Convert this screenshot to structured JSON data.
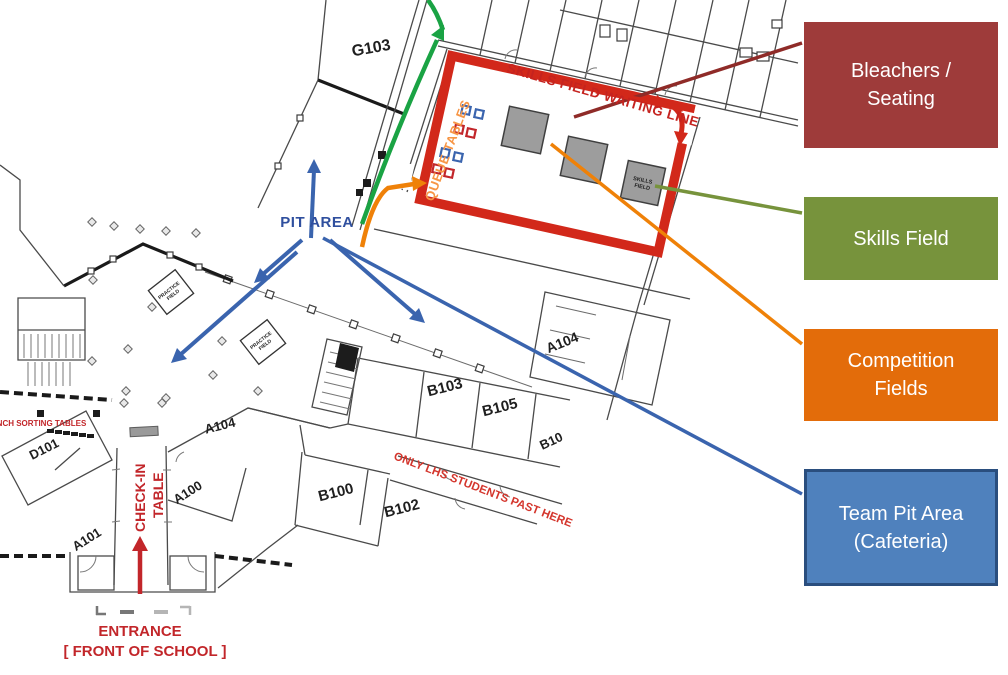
{
  "legend": {
    "items": [
      {
        "label": "Bleachers / Seating",
        "color": "#9e3b3a"
      },
      {
        "label": "Skills Field",
        "color": "#77933c"
      },
      {
        "label": "Competition Fields",
        "color": "#e36c0a"
      },
      {
        "label": "Team Pit Area (Cafeteria)",
        "color": "#4f81bd",
        "border_color": "#2a4e7e"
      }
    ]
  },
  "map": {
    "annotations": {
      "skills_waiting_line": "SKILLS FIELD WAITING LINE",
      "queue_tables": "QUEUE TABLES",
      "pit_area": "PIT AREA",
      "check_in_line1": "CHECK-IN",
      "check_in_line2": "TABLE",
      "entrance_line1": "ENTRANCE",
      "entrance_line2": "[ FRONT OF SCHOOL ]",
      "only_lhs": "ONLY LHS STUDENTS PAST HERE",
      "lunch_sorting": "LUNCH SORTING TABLES",
      "skills_box_line1": "SKILLS",
      "skills_box_line2": "FIELD",
      "practice_line1": "PRACTICE",
      "practice_line2": "FIELD"
    },
    "rooms": [
      {
        "label": "G103"
      },
      {
        "label": "A104"
      },
      {
        "label": "B103"
      },
      {
        "label": "B105"
      },
      {
        "label": "B10"
      },
      {
        "label": "B100"
      },
      {
        "label": "B102"
      },
      {
        "label": "A100"
      },
      {
        "label": "A101"
      },
      {
        "label": "A104"
      },
      {
        "label": "D101"
      }
    ],
    "colors": {
      "map_red": "#c5231f",
      "waiting_line_red": "#d2281a",
      "check_in_red": "#c2262a",
      "queue_orange": "#f79646",
      "arrow_orange": "#ef8108",
      "pit_blue": "#2f4f9e",
      "arrow_blue": "#3a64ae",
      "path_green": "#1aa344",
      "connector_dark_red": "#8f2b28",
      "connector_olive": "#77933c",
      "field_gray": "#9d9d9d"
    }
  }
}
